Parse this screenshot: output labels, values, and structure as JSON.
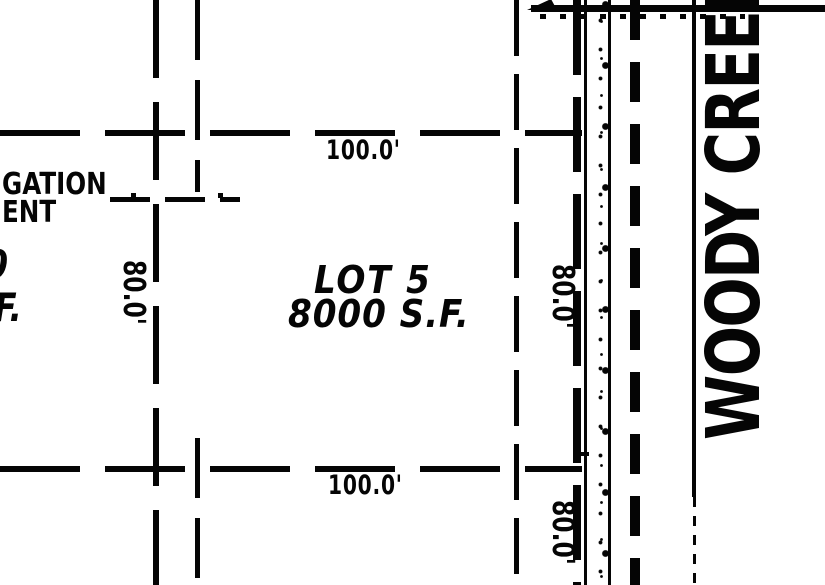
{
  "map": {
    "lot5": {
      "name": "LOT 5",
      "area": "8000 S.F."
    },
    "left_lot": {
      "area_fragment_line1": "0",
      "area_fragment_line2": "F."
    },
    "easement_text": {
      "line1": "GATION",
      "line2": "ENT"
    },
    "street": {
      "name": "WOODY CREEK"
    },
    "dimensions": {
      "north": "100.0'",
      "south": "100.0'",
      "west": "80.0'",
      "east_upper": "80.0'",
      "east_lower": "80.0'"
    },
    "colors": {
      "ink": "#050505",
      "paper": "#ffffff"
    }
  }
}
